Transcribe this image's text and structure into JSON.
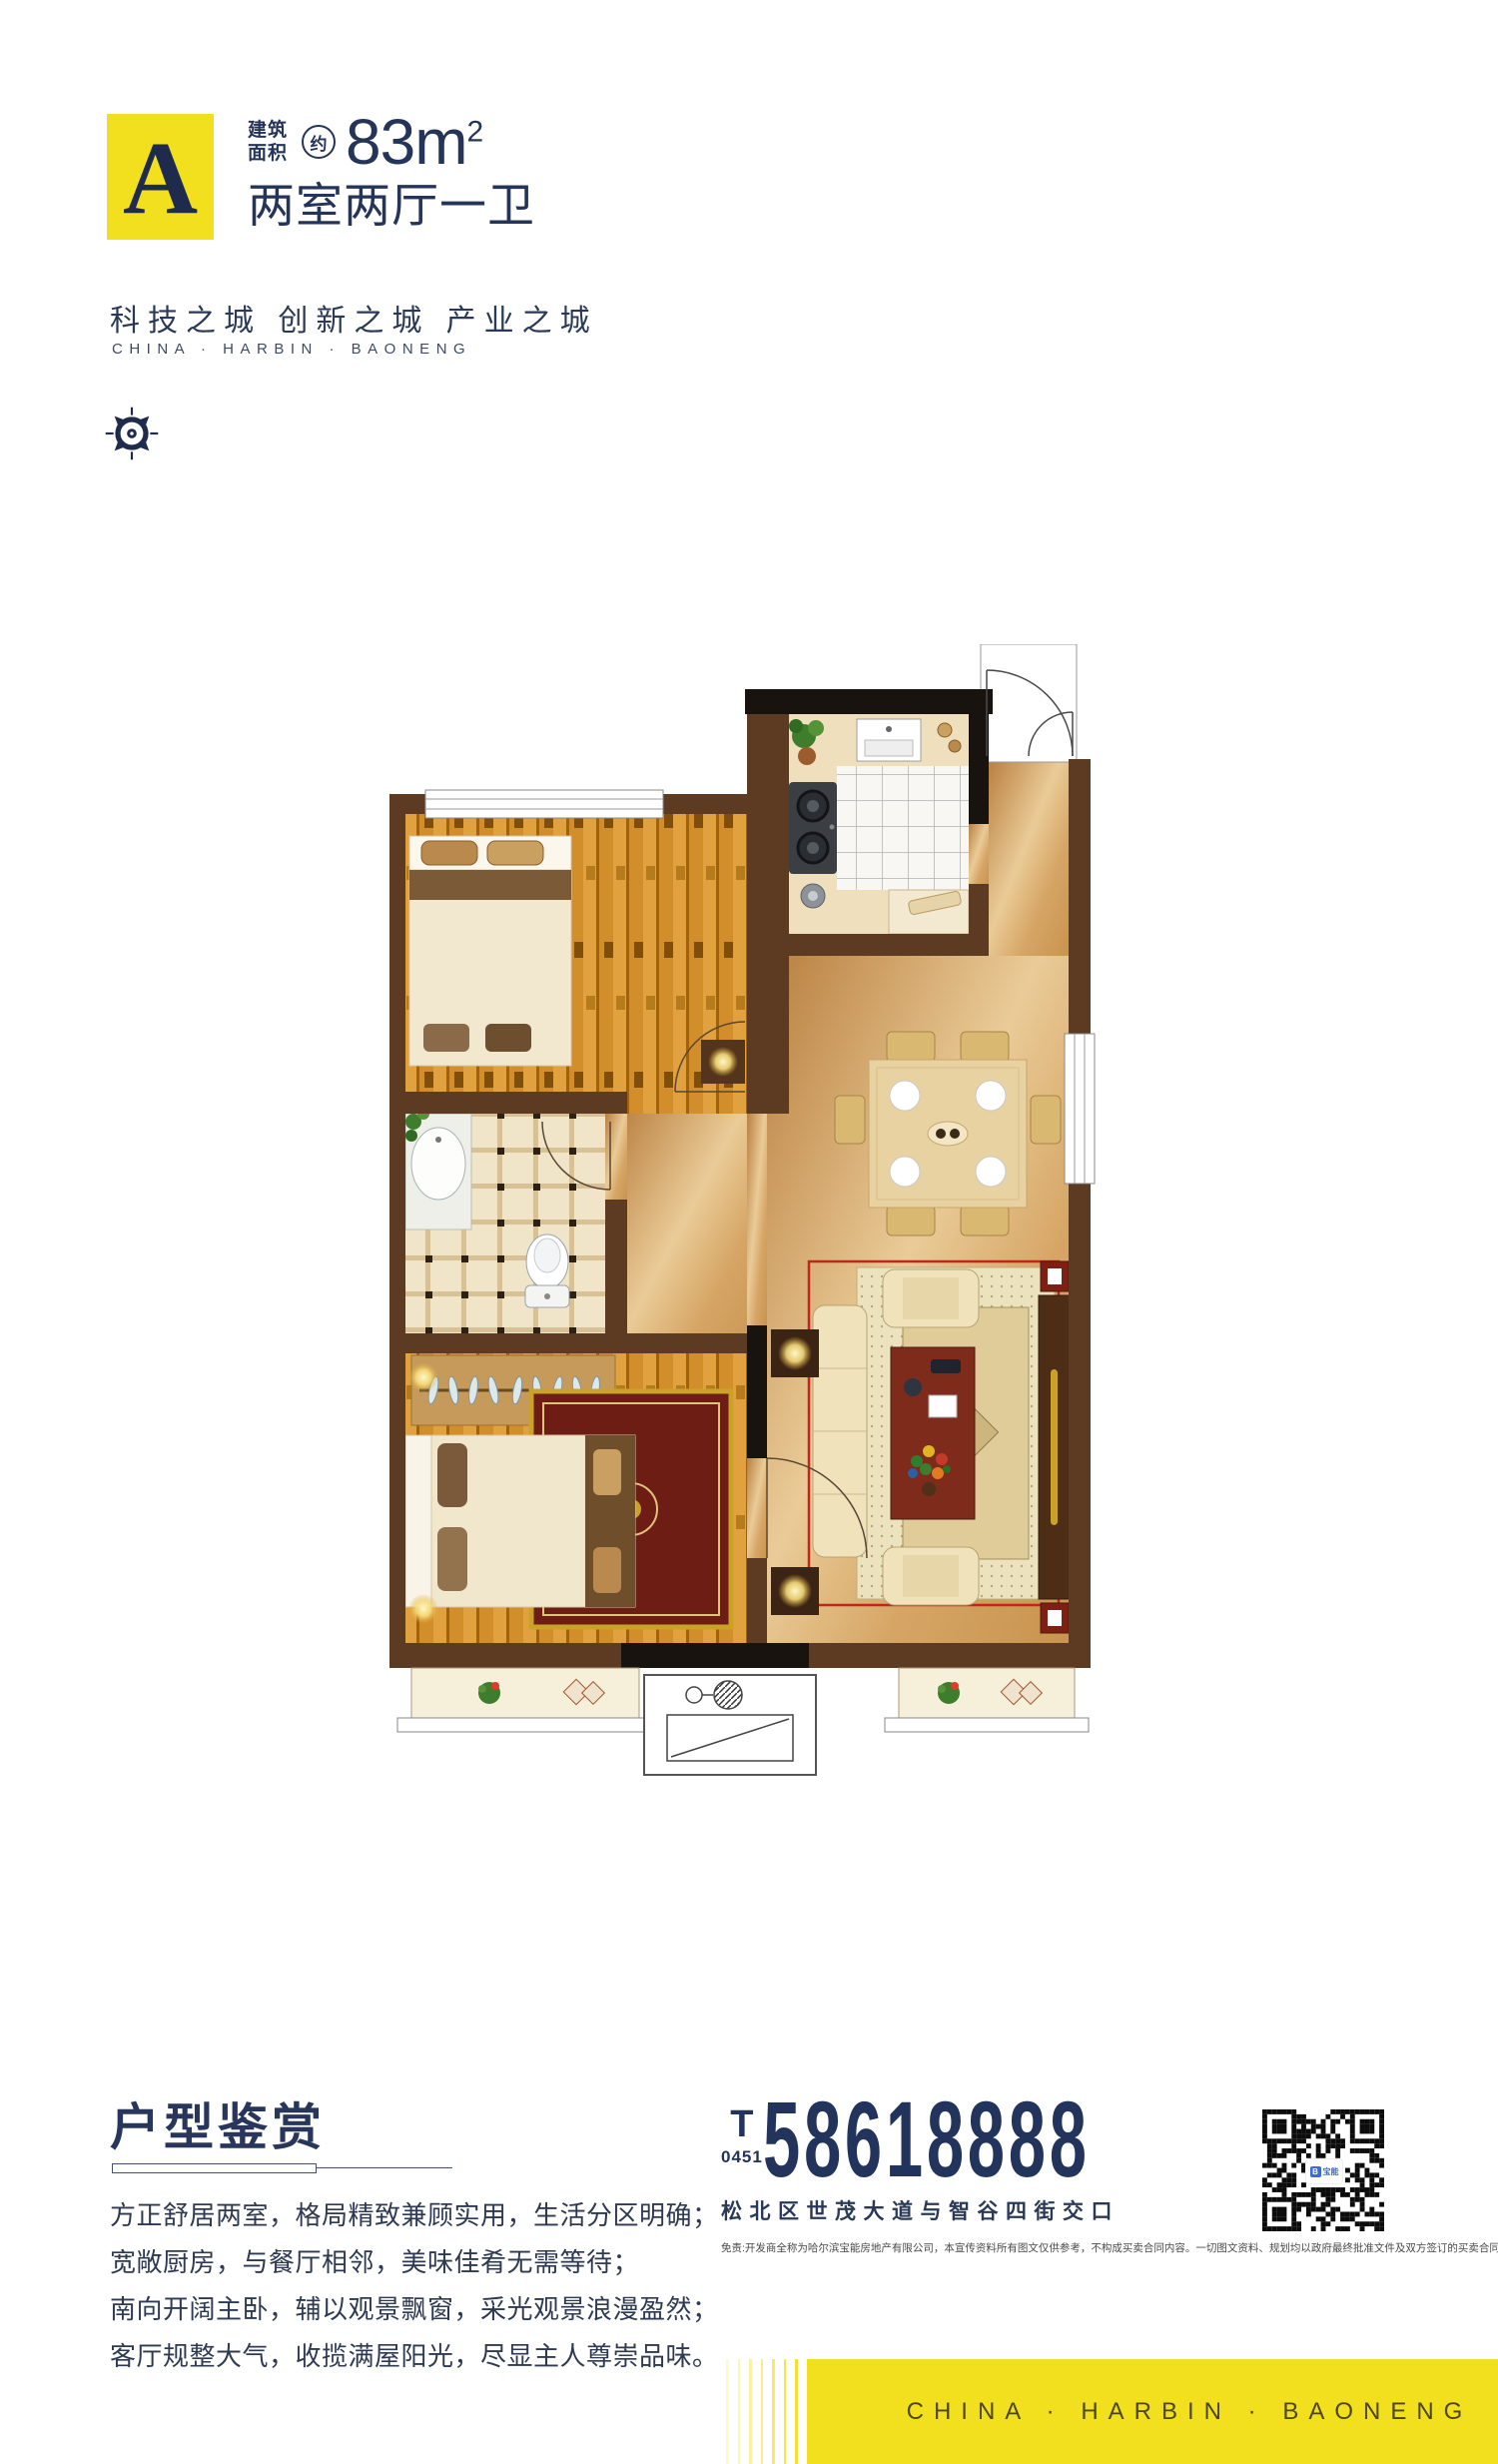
{
  "badge": {
    "letter": "A",
    "area_label_line1": "建筑",
    "area_label_line2": "面积",
    "approx_mark": "约",
    "area_number": "83m",
    "area_sup": "2",
    "layout_title": "两室两厅一卫"
  },
  "tagline": {
    "cn": "科技之城 创新之城 产业之城",
    "en": "CHINA · HARBIN · BAONENG"
  },
  "appreciation": {
    "title": "户型鉴赏",
    "paragraphs": [
      "方正舒居两室，格局精致兼顾实用，生活分区明确；",
      "宽敞厨房，与餐厅相邻，美味佳肴无需等待；",
      "南向开阔主卧，辅以观景飘窗，采光观景浪漫盈然；",
      "客厅规整大气，收揽满屋阳光，尽显主人尊崇品味。"
    ]
  },
  "contact": {
    "tel_prefix": "T",
    "area_code": "0451",
    "phone": "58618888",
    "address": "松北区世茂大道与智谷四街交口",
    "disclaimer": "免责:开发商全称为哈尔滨宝能房地产有限公司，本宣传资料所有图文仅供参考，不构成买卖合同内容。一切图文资料、规划均以政府最终批准文件及双方签订的买卖合同为准。本资料制作时间:2019年11月。",
    "qr_logo": "宝能"
  },
  "footer": {
    "brand": "CHINA · HARBIN · BAONENG"
  },
  "colors": {
    "yellow": "#F2E01F",
    "navy": "#22345C",
    "wall_brown": "#5D3A22",
    "wall_black": "#191310",
    "wood": "#E2A13F",
    "tan": "#D9A96B",
    "accent_red": "#C2251B"
  }
}
